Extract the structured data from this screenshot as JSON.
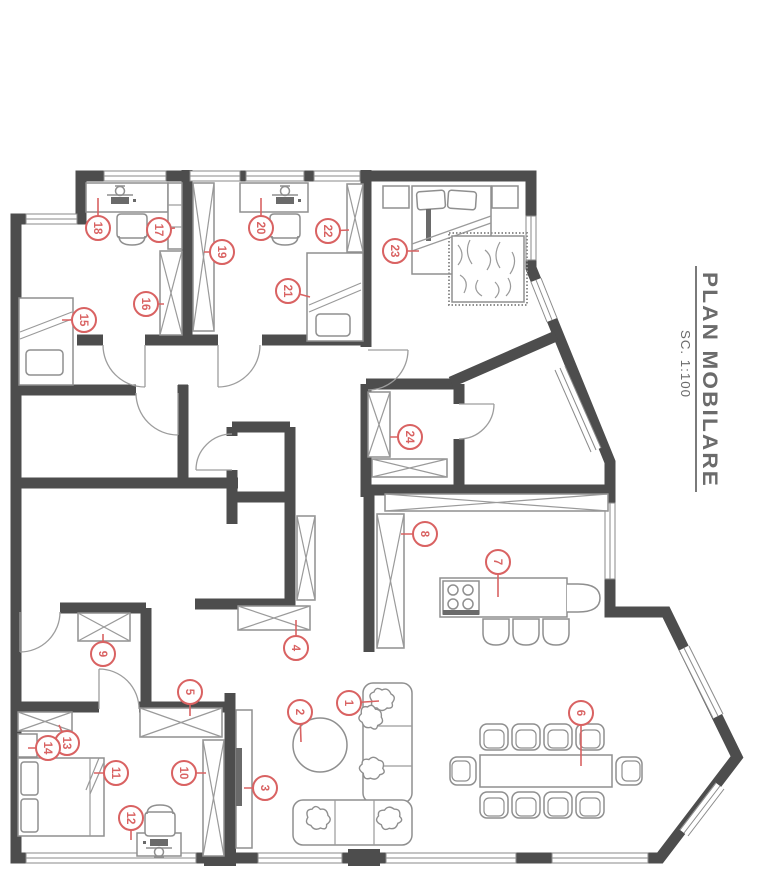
{
  "title_block": {
    "title": "PLAN MOBILARE",
    "scale": "SC. 1:100"
  },
  "colors": {
    "wall": "#4d4d4d",
    "furniture_line": "#8f8f8f",
    "marker": "#d96262",
    "title_text": "#6b6b6b"
  },
  "markers": [
    {
      "n": "1",
      "x": 349,
      "y": 703,
      "tx": 379,
      "ty": 701
    },
    {
      "n": "2",
      "x": 300,
      "y": 712,
      "tx": 301,
      "ty": 742
    },
    {
      "n": "3",
      "x": 265,
      "y": 788,
      "tx": 244,
      "ty": 788
    },
    {
      "n": "4",
      "x": 296,
      "y": 648,
      "tx": 296,
      "ty": 620
    },
    {
      "n": "5",
      "x": 190,
      "y": 692,
      "tx": 190,
      "ty": 716
    },
    {
      "n": "6",
      "x": 581,
      "y": 713,
      "tx": 581,
      "ty": 766
    },
    {
      "n": "7",
      "x": 498,
      "y": 562,
      "tx": 498,
      "ty": 597
    },
    {
      "n": "8",
      "x": 425,
      "y": 534,
      "tx": 401,
      "ty": 534
    },
    {
      "n": "9",
      "x": 103,
      "y": 654,
      "tx": 103,
      "ty": 634
    },
    {
      "n": "10",
      "x": 184,
      "y": 773,
      "tx": 206,
      "ty": 773
    },
    {
      "n": "11",
      "x": 116,
      "y": 773,
      "tx": 94,
      "ty": 773
    },
    {
      "n": "12",
      "x": 131,
      "y": 818,
      "tx": 131,
      "ty": 840
    },
    {
      "n": "13",
      "x": 67,
      "y": 743,
      "tx": 59,
      "ty": 725
    },
    {
      "n": "14",
      "x": 48,
      "y": 748,
      "tx": 28,
      "ty": 748
    },
    {
      "n": "15",
      "x": 84,
      "y": 320,
      "tx": 62,
      "ty": 320
    },
    {
      "n": "16",
      "x": 146,
      "y": 304,
      "tx": 164,
      "ty": 304
    },
    {
      "n": "17",
      "x": 159,
      "y": 230,
      "tx": 175,
      "ty": 228
    },
    {
      "n": "18",
      "x": 98,
      "y": 228,
      "tx": 98,
      "ty": 198
    },
    {
      "n": "19",
      "x": 222,
      "y": 252,
      "tx": 204,
      "ty": 252
    },
    {
      "n": "20",
      "x": 261,
      "y": 228,
      "tx": 261,
      "ty": 198
    },
    {
      "n": "21",
      "x": 288,
      "y": 291,
      "tx": 310,
      "ty": 297
    },
    {
      "n": "22",
      "x": 328,
      "y": 231,
      "tx": 349,
      "ty": 230
    },
    {
      "n": "23",
      "x": 395,
      "y": 251,
      "tx": 419,
      "ty": 251
    },
    {
      "n": "24",
      "x": 410,
      "y": 437,
      "tx": 390,
      "ty": 437
    }
  ]
}
